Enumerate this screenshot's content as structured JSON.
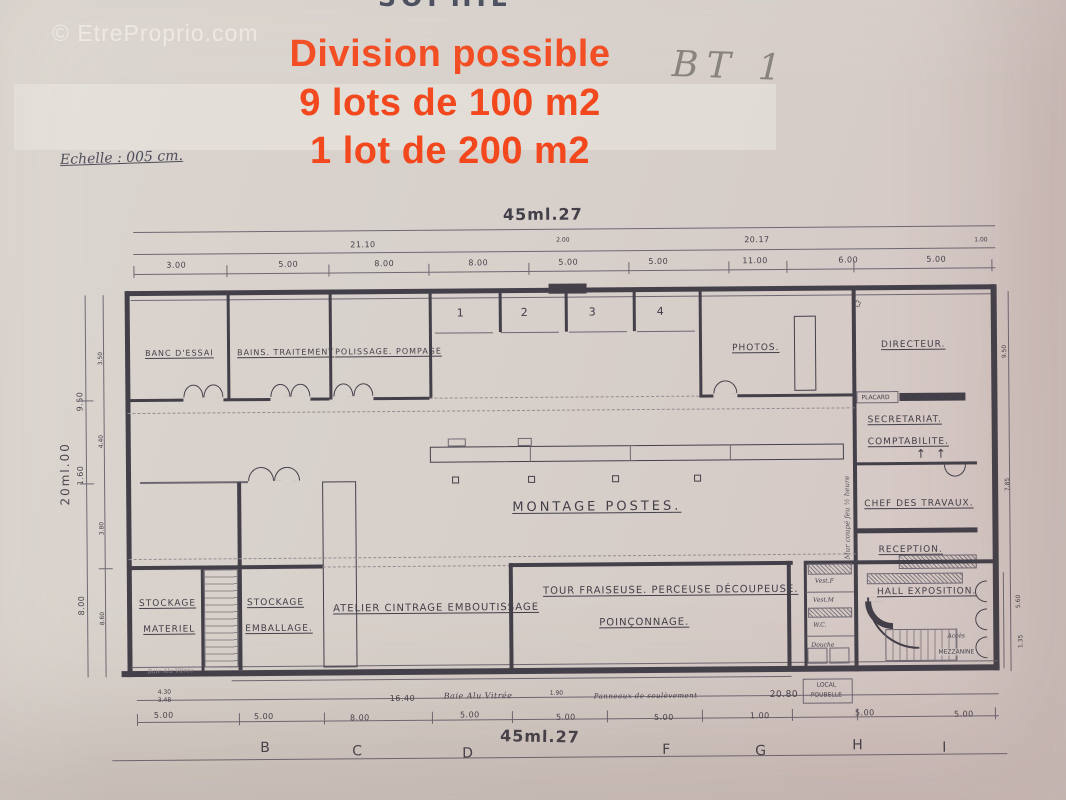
{
  "photo": {
    "watermark": "© EtreProprio.com",
    "top_crop": "SOPHIE",
    "bt1": "BT 1",
    "scale_note": "Echelle : 005 cm."
  },
  "overlay": {
    "color": "#f3481d",
    "lines": [
      "Division possible",
      "9 lots de 100 m2",
      "1 lot de 200 m2"
    ]
  },
  "plan": {
    "dims": {
      "top_total": "45ml.27",
      "bottom_total": "45ml.27",
      "left_total": "20ml.00",
      "top_spans": [
        "21.10",
        "2.00",
        "20.17",
        "1.00"
      ],
      "top_segments": [
        "3.00",
        "5.00",
        "8.00",
        "8.00",
        "5.00",
        "5.00",
        "11.00",
        "6.00",
        "5.00"
      ],
      "left_chain": [
        "9.50",
        "1.60",
        "8.00"
      ],
      "left_inner": [
        "3.50",
        "4.40",
        "3.80",
        "8.60"
      ],
      "right_chain": [
        "9.50",
        "7.85",
        "5.60",
        "1.35"
      ],
      "bottom_stack": [
        "4.30",
        "3.48"
      ],
      "bottom_vals": [
        "16.40",
        "1.90",
        "20.80"
      ],
      "bottom_segments": [
        "5.00",
        "5.00",
        "8.00",
        "5.00",
        "5.00",
        "5.00",
        "1.00",
        "5.00",
        "5.00"
      ],
      "grid_letters": [
        "B",
        "C",
        "D",
        "F",
        "G",
        "H",
        "I"
      ]
    },
    "bays": [
      "1",
      "2",
      "3",
      "4"
    ],
    "rooms": {
      "banc": "BANC D'ESSAI",
      "bains": "BAINS. TRAITEMENT",
      "polissage": "POLISSAGE. POMPAGE",
      "photos": "PHOTOS.",
      "directeur": "DIRECTEUR.",
      "placard": "PLACARD",
      "secretariat": "SECRETARIAT.",
      "comptabilite": "COMPTABILITE.",
      "chef": "CHEF DES TRAVAUX.",
      "reception": "RECEPTION.",
      "montage": "MONTAGE POSTES.",
      "stock1a": "STOCKAGE",
      "stock1b": "MATERIEL",
      "stock2a": "STOCKAGE",
      "stock2b": "EMBALLAGE.",
      "atelier": "ATELIER CINTRAGE EMBOUTISSAGE",
      "tour": "TOUR FRAISEUSE. PERCEUSE DÉCOUPEUSE.",
      "poinconnage": "POINÇONNAGE.",
      "hall": "HALL EXPOSITION.",
      "vest_f": "Vest.F",
      "vest_m": "Vest.M",
      "wc": "W.C.",
      "douche": "Douche",
      "local1": "LOCAL",
      "local2": "POUBELLE"
    },
    "notes": {
      "mur_coupe_feu": "Mur coupé feu ½ heure",
      "baie_alu": "Baie Alu Vitrée",
      "baie_left": "Baie Alu Vitrée",
      "panneaux": "Panneaux de soulèvement",
      "acces": "Accès",
      "mezzanine": "MEZZANINE",
      "star": "✩",
      "arrow": "↑"
    }
  }
}
